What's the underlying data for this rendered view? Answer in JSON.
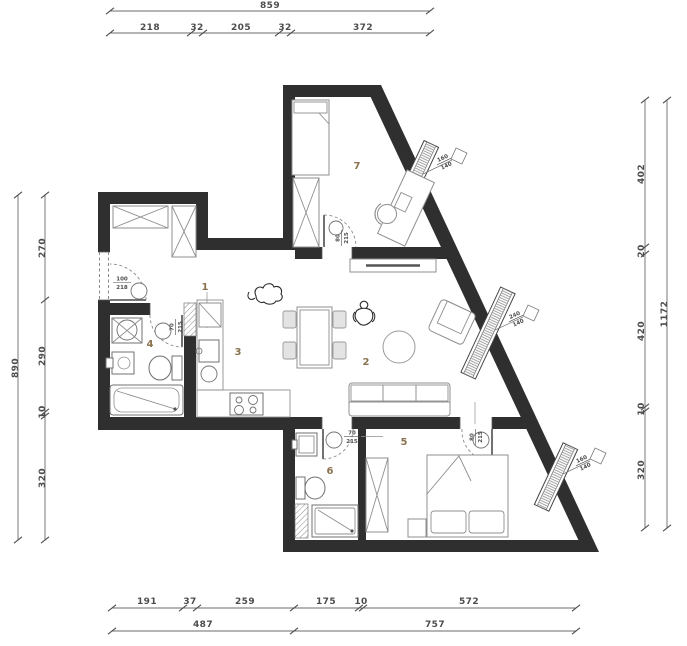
{
  "drawing": {
    "kind": "apartment-floor-plan"
  },
  "colors": {
    "wall": "#2f2f2f",
    "dimension_text": "#4d4d4d",
    "room_number": "#8a7350",
    "furniture_outline": "#8f8f8f",
    "background": "#ffffff"
  },
  "rooms": [
    {
      "label": "1"
    },
    {
      "label": "2"
    },
    {
      "label": "3"
    },
    {
      "label": "4"
    },
    {
      "label": "5"
    },
    {
      "label": "6"
    },
    {
      "label": "7"
    }
  ],
  "dimensions": {
    "top": {
      "total": "859",
      "segments": [
        "218",
        "32",
        "205",
        "32",
        "372"
      ]
    },
    "left": {
      "total": "890",
      "segments": [
        "270",
        "290",
        "10",
        "320"
      ]
    },
    "right": {
      "total": "1172",
      "segments": [
        "402",
        "20",
        "420",
        "10",
        "320"
      ]
    },
    "bottom": {
      "segments": [
        "191",
        "37",
        "259",
        "175",
        "10",
        "572"
      ],
      "totals": [
        "487",
        "757"
      ]
    }
  },
  "doors": {
    "entry": {
      "w": "100",
      "h": "218"
    },
    "bathroom": {
      "w": "70",
      "h": "215"
    },
    "wc": {
      "w": "70",
      "h": "215"
    },
    "bedroom": {
      "w": "80",
      "h": "215"
    },
    "room7": {
      "w": "80",
      "h": "215"
    }
  },
  "windows": {
    "room7": {
      "w": "160",
      "h": "140"
    },
    "living": {
      "w": "240",
      "h": "140"
    },
    "bedroom": {
      "w": "160",
      "h": "140"
    }
  }
}
